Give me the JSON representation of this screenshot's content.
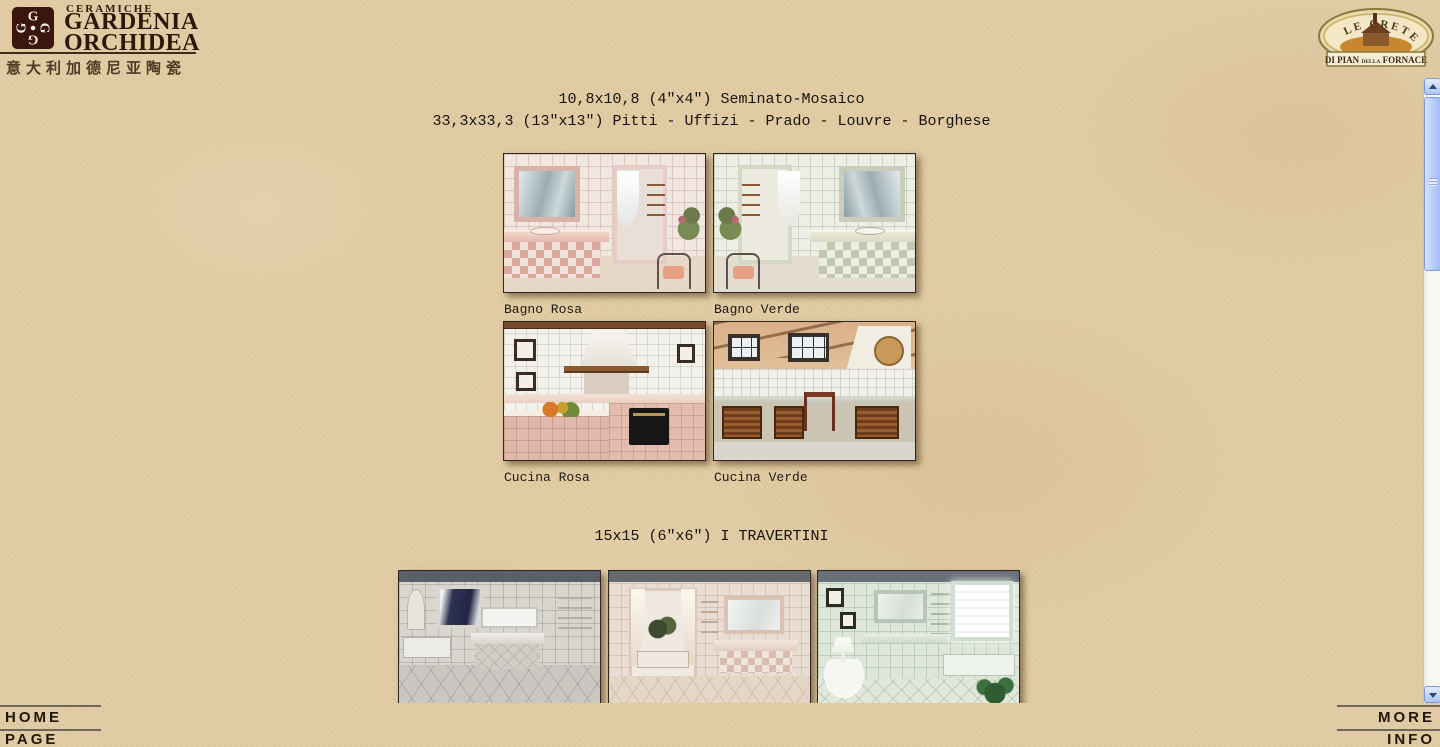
{
  "header": {
    "logo": {
      "eyebrow": "CERAMICHE",
      "name_line1": "GARDENIA",
      "name_line2": "ORCHIDEA",
      "subtitle_cn": "意大利加德尼亚陶瓷",
      "monogram_letter": "G"
    },
    "badge": {
      "arc_text": "LE CRETE",
      "banner_di_pian": "DI PIAN",
      "banner_della": "DELLA",
      "banner_fornace": "FORNACE"
    }
  },
  "main": {
    "section1": {
      "title_line1": "10,8x10,8 (4″x4″) Seminato-Mosaico",
      "title_line2": "33,3x33,3 (13″x13″) Pitti - Uffizi - Prado - Louvre - Borghese",
      "items": [
        {
          "caption": "Bagno Rosa"
        },
        {
          "caption": "Bagno Verde"
        },
        {
          "caption": "Cucina Rosa"
        },
        {
          "caption": "Cucina Verde"
        }
      ]
    },
    "section2": {
      "title": "15x15 (6″x6″) I TRAVERTINI",
      "image_count": "3"
    }
  },
  "footer": {
    "home_label": "HOME PAGE",
    "more_label": "MORE INFO"
  },
  "colors": {
    "page_background": "#e2cca4",
    "logo_square": "#3b160e",
    "logo_text": "#2e1708",
    "badge_gold": "#8a7a3a",
    "scrollbar_blue": "#b7cdfb",
    "heading_text": "#15130f"
  }
}
